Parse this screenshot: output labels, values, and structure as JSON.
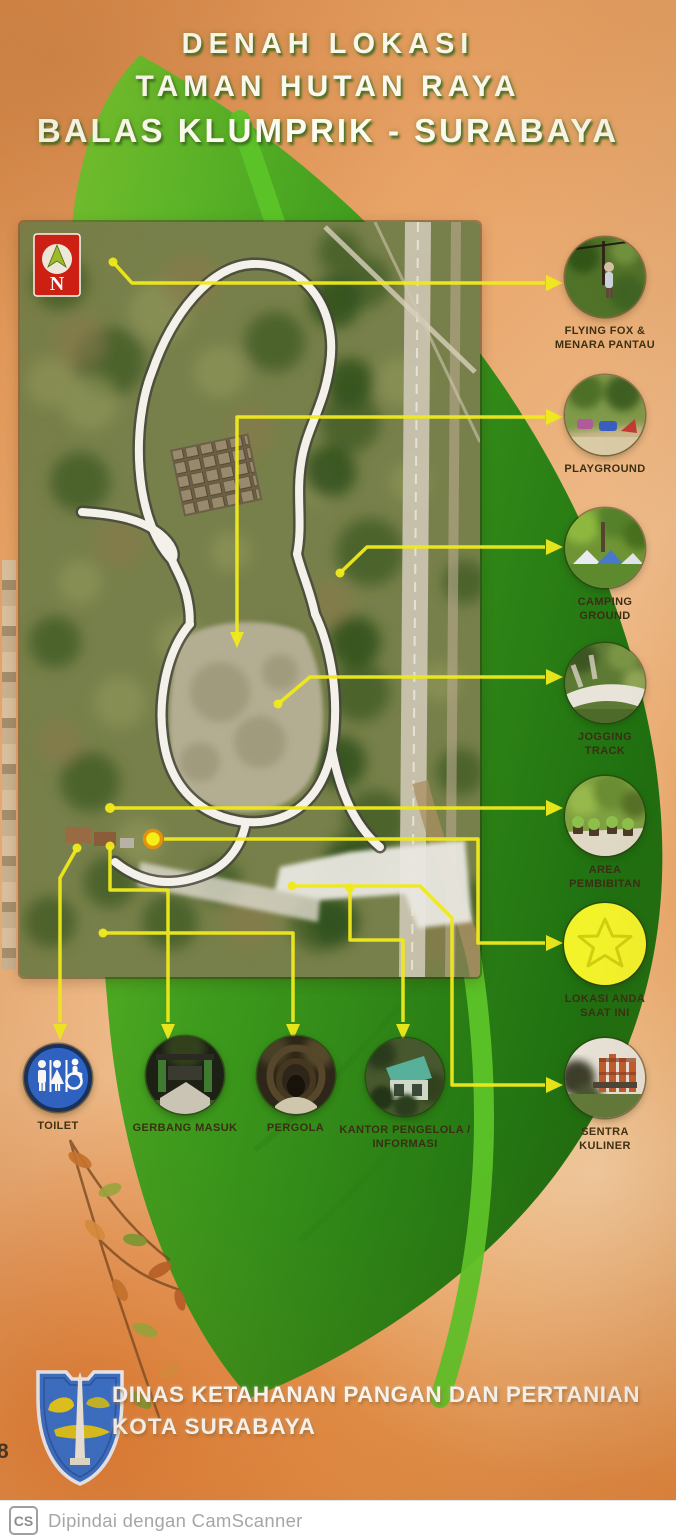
{
  "title": {
    "line1": "DENAH LOKASI",
    "line2": "TAMAN HUTAN RAYA",
    "line3": "BALAS KLUMPRIK - SURABAYA"
  },
  "map": {
    "north_label": "N"
  },
  "right_callouts": [
    {
      "line1": "FLYING FOX &",
      "line2": "MENARA PANTAU"
    },
    {
      "line1": "PLAYGROUND",
      "line2": ""
    },
    {
      "line1": "CAMPING",
      "line2": "GROUND"
    },
    {
      "line1": "JOGGING",
      "line2": "TRACK"
    },
    {
      "line1": "AREA",
      "line2": "PEMBIBITAN"
    },
    {
      "line1": "LOKASI ANDA",
      "line2": "SAAT INI"
    },
    {
      "line1": "SENTRA",
      "line2": "KULINER"
    }
  ],
  "bottom_callouts": [
    {
      "line1": "TOILET",
      "line2": ""
    },
    {
      "line1": "GERBANG MASUK",
      "line2": ""
    },
    {
      "line1": "PERGOLA",
      "line2": ""
    },
    {
      "line1": "KANTOR PENGELOLA /",
      "line2": "INFORMASI"
    }
  ],
  "footer": {
    "line1": "DINAS KETAHANAN PANGAN DAN PERTANIAN",
    "line2": "KOTA SURABAYA"
  },
  "scanner_bar": {
    "logo": "CS",
    "text": "Dipindai dengan CamScanner"
  },
  "scan_artifact": "8",
  "colors": {
    "background_orange": "#e1904a",
    "leaf_green": "#3f9c1d",
    "connector_yellow": "#f0ea1c",
    "current_location_star": "#f3f32a",
    "toilet_blue": "#2a63c8",
    "north_badge_red": "#cf1d13",
    "title_text": "#fdfdf2",
    "label_text": "#3a2f14"
  }
}
